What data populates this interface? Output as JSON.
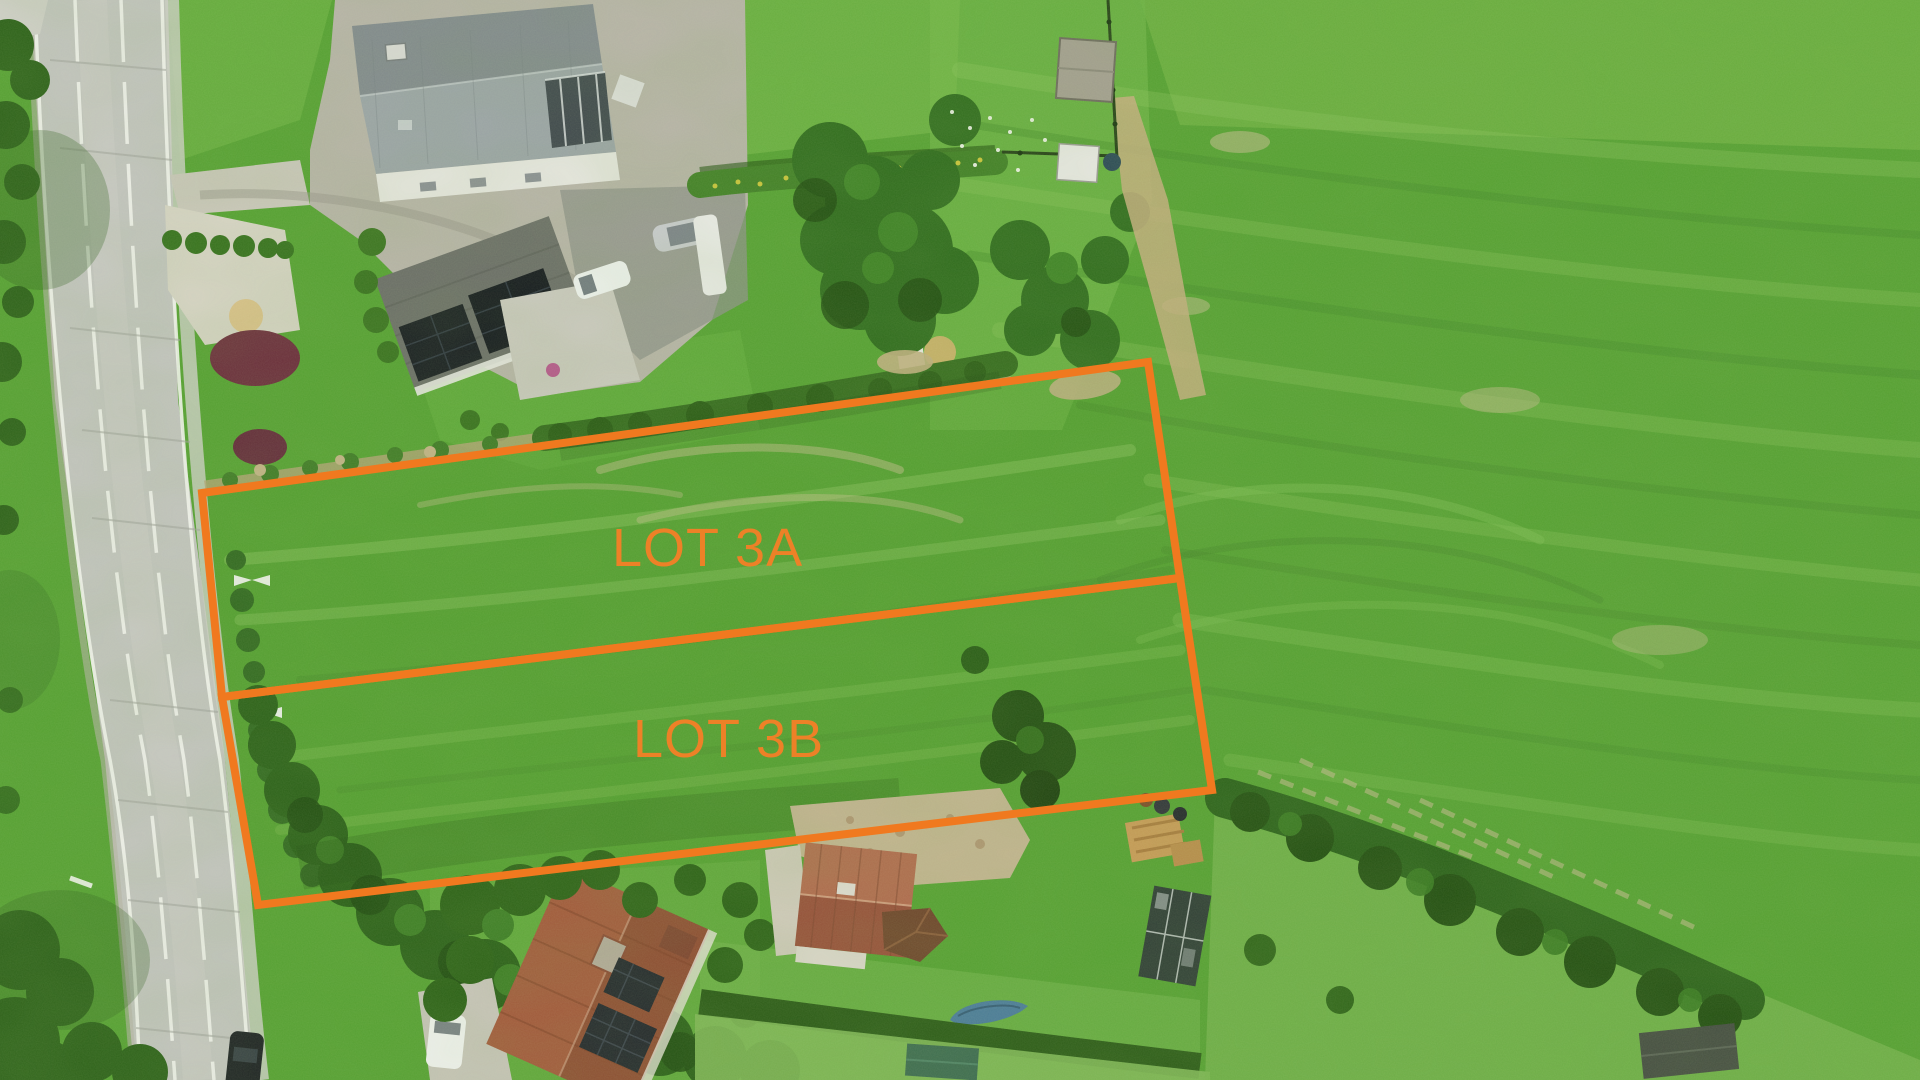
{
  "scene": {
    "description": "Aerial drone photo: two grassland building lots outlined in orange beside a road, houses top-left and bottom, large mowed field to the right"
  },
  "annotations": {
    "stroke_color": "#F0791F",
    "label_color": "#ED8127",
    "stroke_width": 8,
    "label_font_size": 54,
    "lots": [
      {
        "id": "lot-3a",
        "label": "LOT 3A",
        "points": "202,493 1148,362 1180,578 222,697",
        "label_x": "612",
        "label_y": "566"
      },
      {
        "id": "lot-3b",
        "label": "LOT 3B",
        "points": "222,697 1180,578 1212,790 258,905",
        "label_x": "633",
        "label_y": "757"
      }
    ]
  }
}
